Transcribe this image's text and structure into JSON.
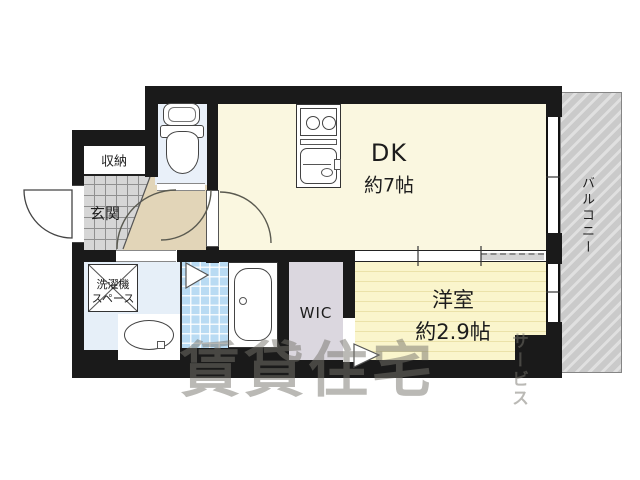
{
  "rooms": {
    "dk": {
      "label": "DK",
      "size": "約7帖"
    },
    "western": {
      "label": "洋室",
      "size": "約2.9帖"
    },
    "wic": {
      "label": "WIC"
    },
    "entrance": {
      "label": "玄関"
    },
    "storage": {
      "label": "収納"
    },
    "laundry": {
      "line1": "洗濯機",
      "line2": "スペース"
    },
    "balcony": {
      "label": "バルコニー"
    }
  },
  "watermark": {
    "main": "賃貸住宅",
    "sub": "サービス"
  },
  "colors": {
    "wall": "#1a1a1a",
    "dk": "#faf7e0",
    "hall": "#e2d5b8",
    "tile": "#d6d6d6",
    "tileline": "#909090",
    "toilet": "#e9f0f9",
    "wash": "#e6eff8",
    "bath": "#b9dbf3",
    "wic": "#dbd7df",
    "west": "#faf5cc",
    "westline": "#ebe2a9",
    "balc": "#cacaca",
    "balcline": "#e0e0e0",
    "wm": "rgba(118,116,108,0.5)"
  }
}
